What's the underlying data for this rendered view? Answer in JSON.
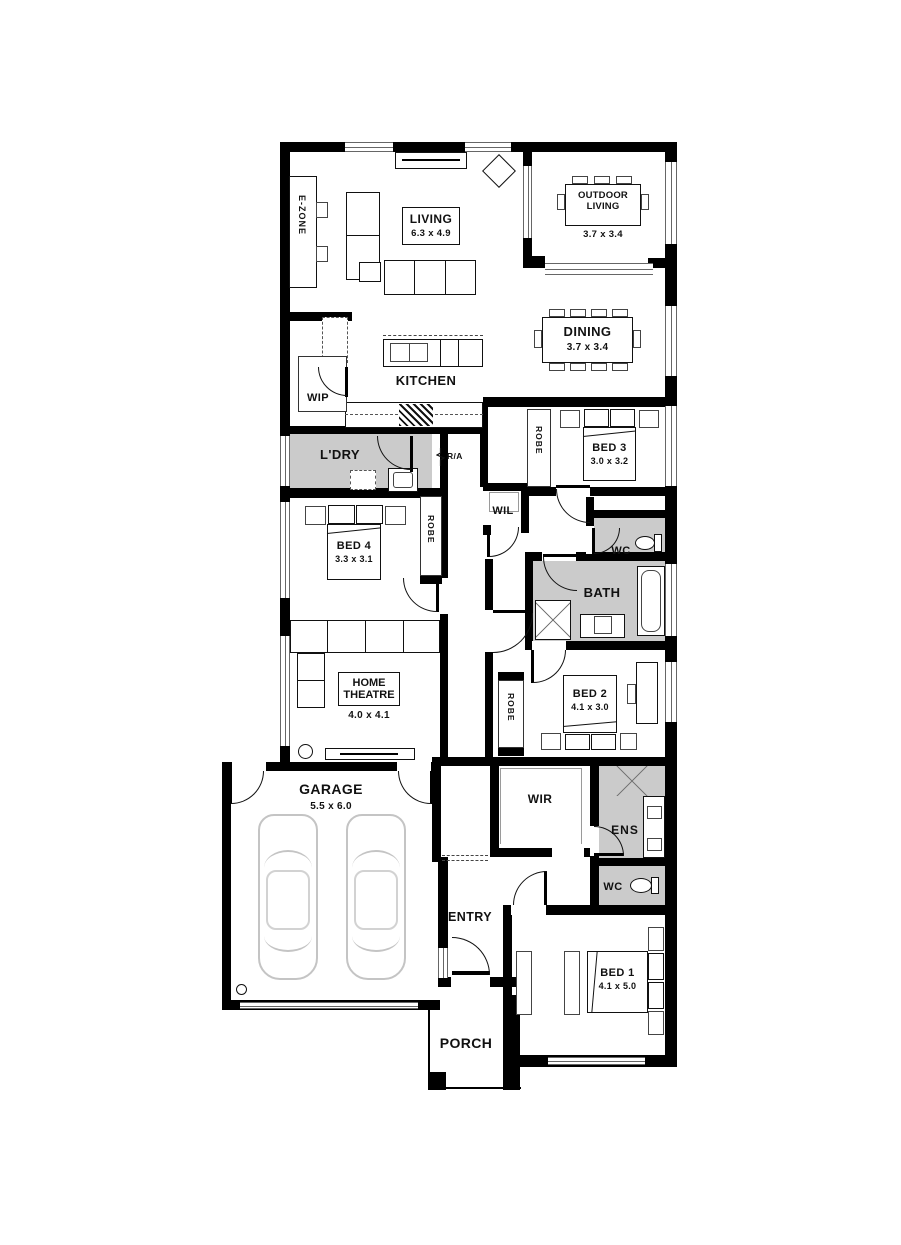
{
  "plan": {
    "rooms": {
      "living": {
        "name": "LIVING",
        "dims": "6.3 x 4.9"
      },
      "outdoor": {
        "name": "OUTDOOR LIVING",
        "dims": "3.7 x 3.4"
      },
      "dining": {
        "name": "DINING",
        "dims": "3.7 x 3.4"
      },
      "kitchen": {
        "name": "KITCHEN"
      },
      "wip": {
        "name": "WIP"
      },
      "ldry": {
        "name": "L'DRY"
      },
      "bed3": {
        "name": "BED 3",
        "dims": "3.0 x 3.2"
      },
      "bed4": {
        "name": "BED 4",
        "dims": "3.3 x 3.1"
      },
      "wil": {
        "name": "WIL"
      },
      "wc1": {
        "name": "WC"
      },
      "bath": {
        "name": "BATH"
      },
      "home_theatre": {
        "name": "HOME THEATRE",
        "dims": "4.0 x 4.1"
      },
      "bed2": {
        "name": "BED 2",
        "dims": "4.1 x 3.0"
      },
      "garage": {
        "name": "GARAGE",
        "dims": "5.5 x 6.0"
      },
      "wir": {
        "name": "WIR"
      },
      "ens": {
        "name": "ENS"
      },
      "wc2": {
        "name": "WC"
      },
      "entry": {
        "name": "ENTRY"
      },
      "bed1": {
        "name": "BED 1",
        "dims": "4.1 x 5.0"
      },
      "porch": {
        "name": "PORCH"
      }
    },
    "annotations": {
      "ezone": "E-ZONE",
      "robe": "ROBE",
      "ra": "R/A"
    },
    "colors": {
      "wall": "#000000",
      "wet_area": "#cbcbcb",
      "line": "#111111",
      "car_line": "#c4c4c4"
    }
  }
}
